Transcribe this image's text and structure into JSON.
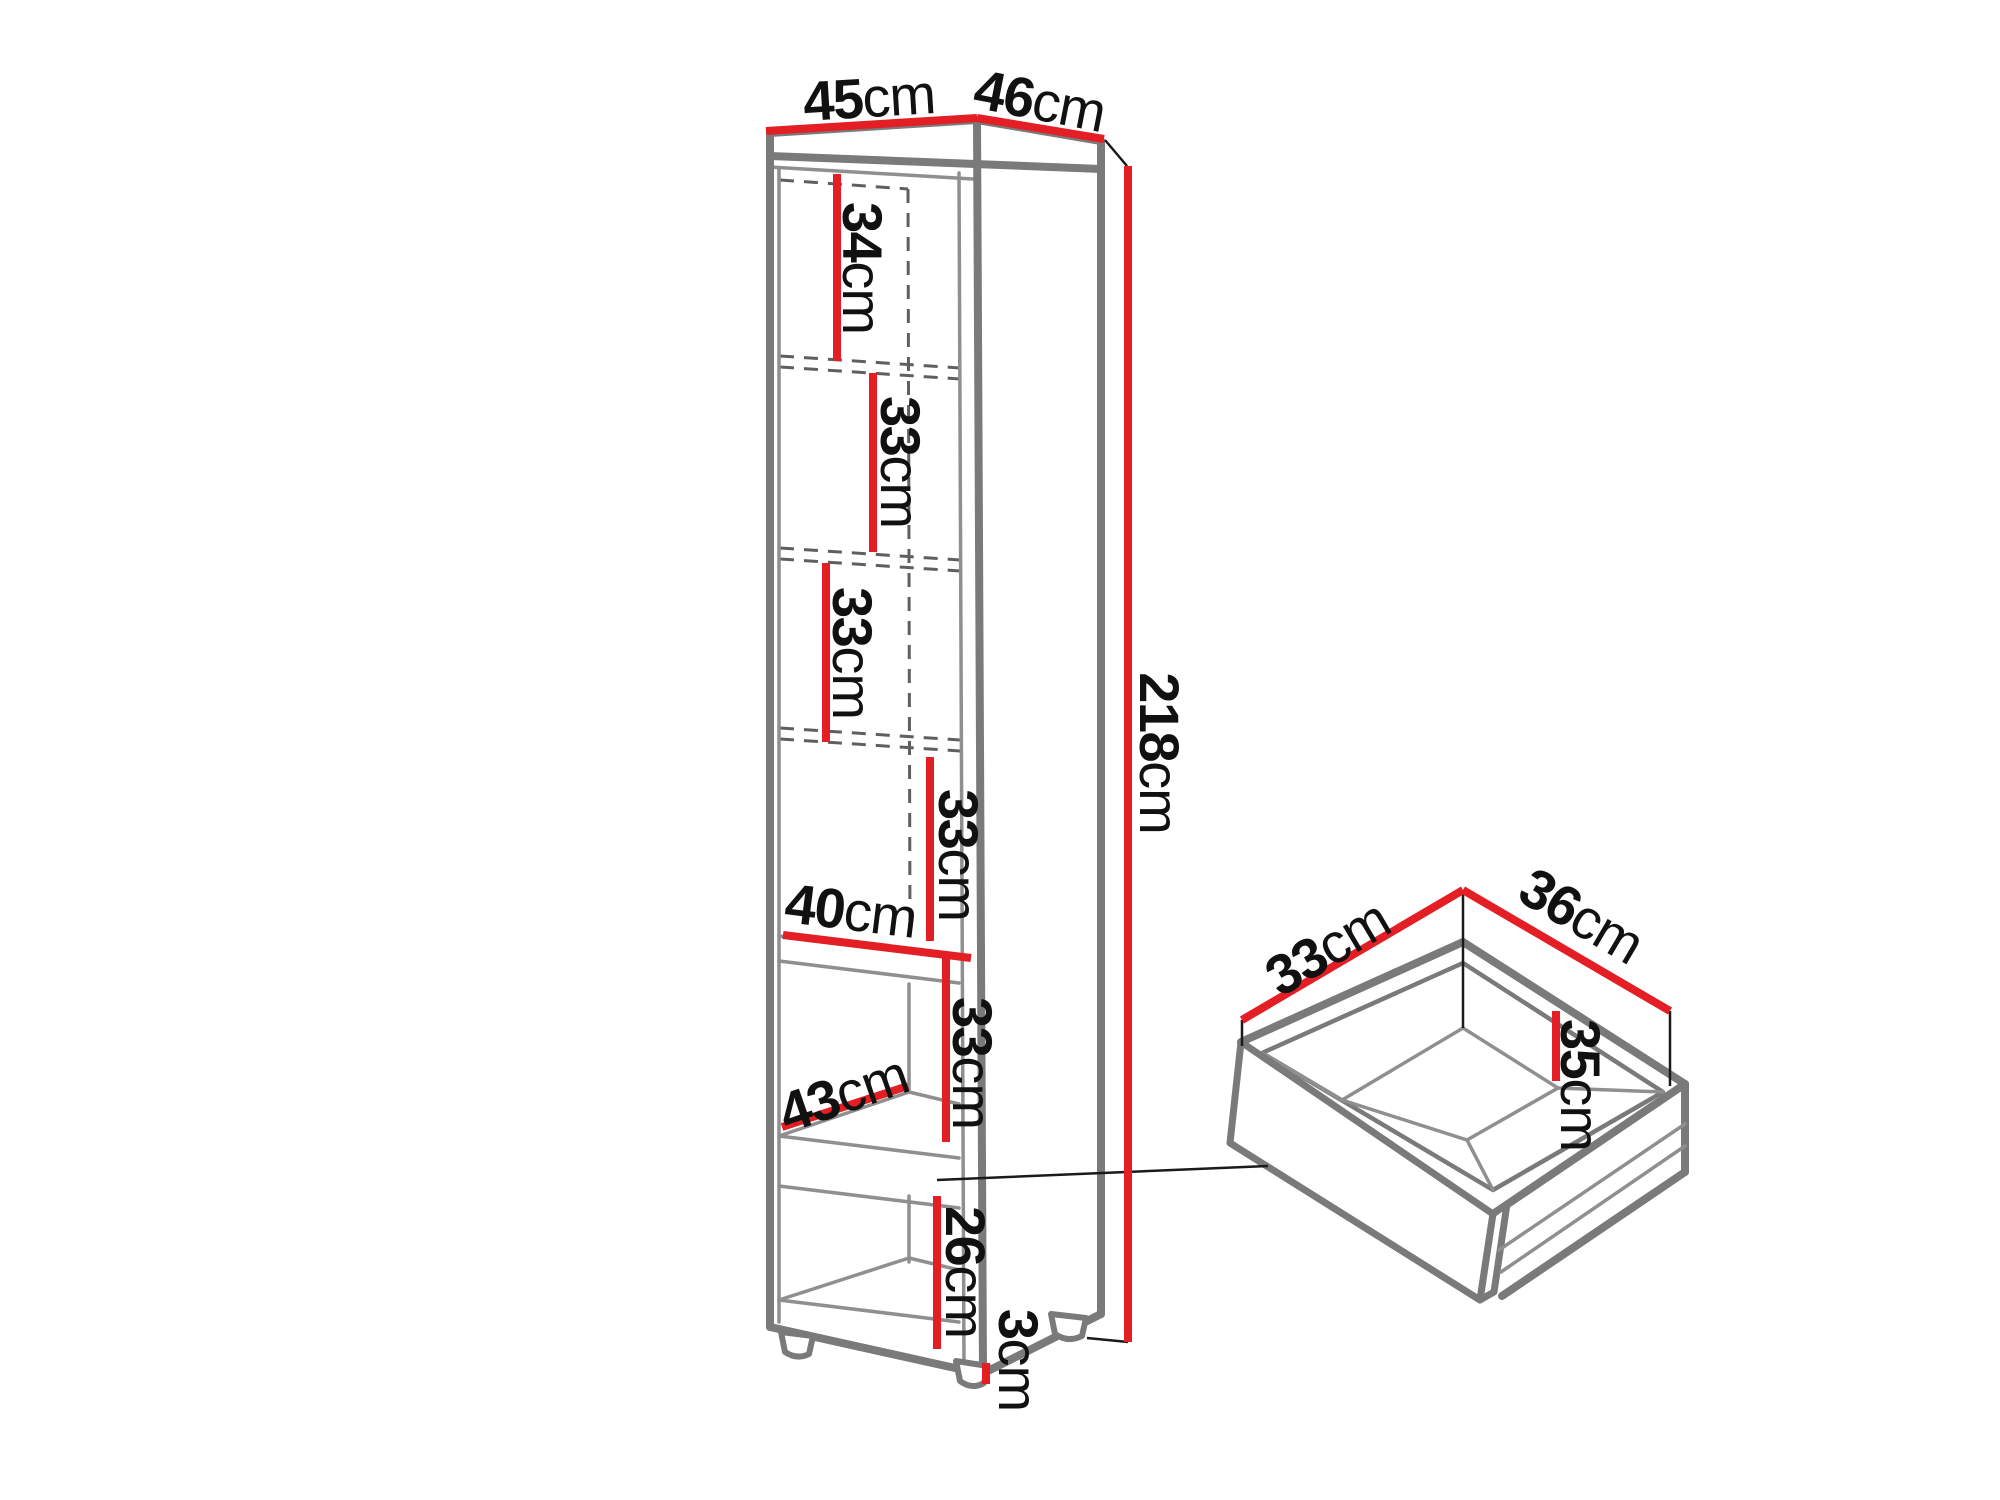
{
  "colors": {
    "dimension_red": "#e31e24",
    "outline_gray": "#7a7a7a",
    "line_thin": "#8f8f8f",
    "hidden_dash": "#5f5f5f",
    "extension_black": "#1a1a1a",
    "text": "#111111",
    "background": "#ffffff"
  },
  "cabinet": {
    "top_width": {
      "value": "45",
      "unit": "cm"
    },
    "top_depth": {
      "value": "46",
      "unit": "cm"
    },
    "total_height": {
      "value": "218",
      "unit": "cm"
    },
    "sections": [
      {
        "value": "34",
        "unit": "cm"
      },
      {
        "value": "33",
        "unit": "cm"
      },
      {
        "value": "33",
        "unit": "cm"
      },
      {
        "value": "33",
        "unit": "cm"
      },
      {
        "value": "33",
        "unit": "cm"
      }
    ],
    "bottom_section": {
      "value": "26",
      "unit": "cm"
    },
    "shelf_width": {
      "value": "40",
      "unit": "cm"
    },
    "shelf_depth": {
      "value": "43",
      "unit": "cm"
    },
    "foot_height": {
      "value": "3",
      "unit": "cm"
    }
  },
  "drawer": {
    "width": {
      "value": "33",
      "unit": "cm"
    },
    "depth": {
      "value": "36",
      "unit": "cm"
    },
    "inner_depth": {
      "value": "35",
      "unit": "cm"
    }
  }
}
